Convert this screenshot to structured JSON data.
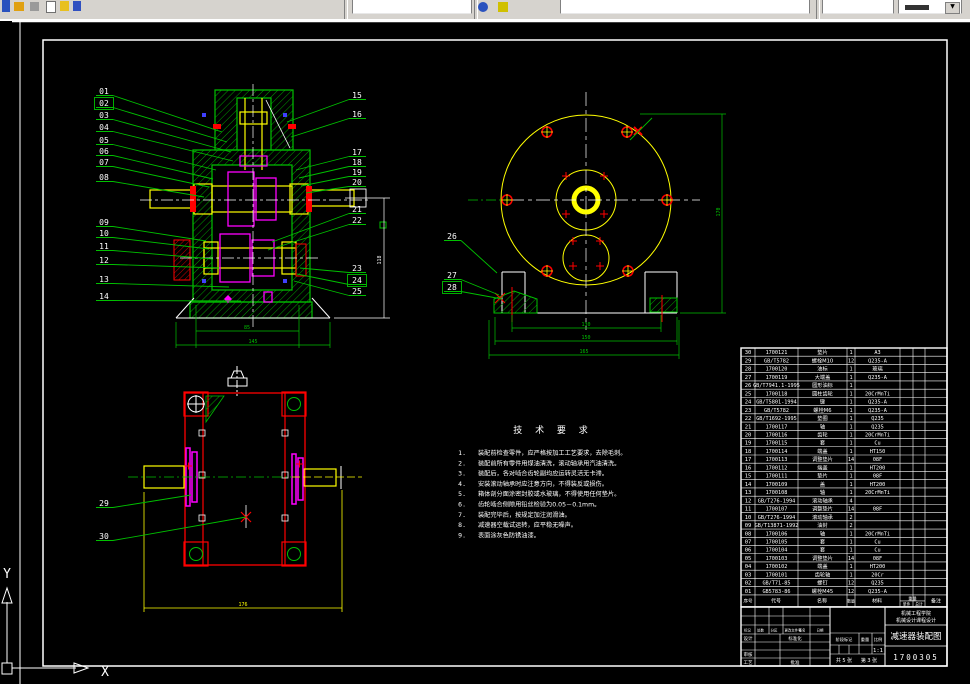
{
  "toolbar": {
    "layer_combo_value": "ByLayer"
  },
  "frame": {
    "ucs_x_label": "X",
    "ucs_y_label": "Y"
  },
  "tech": {
    "title": "技 术 要 求",
    "items": [
      "装配前检查零件，应严格按加工工艺要求，去除毛刺。",
      "装配前所有零件用煤油清洗，滚动轴承用汽油清洗。",
      "装配后，各对啮合齿轮副均应运转灵活无卡滞。",
      "安装滚动轴承时应注意方向，不得装反或损伤。",
      "箱体剖分面涂密封胶或水玻璃，不得使用任何垫片。",
      "齿轮啮合侧隙用铅丝检验为0.05－0.1mm。",
      "装配完毕后，按规定加注润滑油。",
      "减速器空载试运转，应平稳无噪声。",
      "表面涂灰色防锈油漆。"
    ]
  },
  "dims": {
    "view1_bottom": [
      "85",
      "145"
    ],
    "view1_side": "118",
    "view2_bottom": [
      "130",
      "150",
      "165"
    ],
    "view2_side": "170",
    "view3_width": "176"
  },
  "callouts": [
    {
      "n": "01",
      "x": 104,
      "y": 91,
      "tx": 222,
      "ty": 132,
      "s": "L",
      "b": false
    },
    {
      "n": "02",
      "x": 104,
      "y": 103,
      "tx": 227,
      "ty": 142,
      "s": "L",
      "b": true
    },
    {
      "n": "03",
      "x": 104,
      "y": 115,
      "tx": 231,
      "ty": 152,
      "s": "L",
      "b": false
    },
    {
      "n": "04",
      "x": 104,
      "y": 127,
      "tx": 233,
      "ty": 161,
      "s": "L",
      "b": false
    },
    {
      "n": "05",
      "x": 104,
      "y": 140,
      "tx": 216,
      "ty": 170,
      "s": "L",
      "b": false
    },
    {
      "n": "06",
      "x": 104,
      "y": 151,
      "tx": 213,
      "ty": 179,
      "s": "L",
      "b": false
    },
    {
      "n": "07",
      "x": 104,
      "y": 162,
      "tx": 209,
      "ty": 187,
      "s": "L",
      "b": false
    },
    {
      "n": "08",
      "x": 104,
      "y": 177,
      "tx": 204,
      "ty": 197,
      "s": "L",
      "b": false
    },
    {
      "n": "09",
      "x": 104,
      "y": 222,
      "tx": 206,
      "ty": 241,
      "s": "L",
      "b": false
    },
    {
      "n": "10",
      "x": 104,
      "y": 233,
      "tx": 209,
      "ty": 249,
      "s": "L",
      "b": false
    },
    {
      "n": "11",
      "x": 104,
      "y": 246,
      "tx": 213,
      "ty": 259,
      "s": "L",
      "b": false
    },
    {
      "n": "12",
      "x": 104,
      "y": 260,
      "tx": 219,
      "ty": 268,
      "s": "L",
      "b": false
    },
    {
      "n": "13",
      "x": 104,
      "y": 279,
      "tx": 229,
      "ty": 287,
      "s": "L",
      "b": false
    },
    {
      "n": "14",
      "x": 104,
      "y": 296,
      "tx": 241,
      "ty": 301,
      "s": "L",
      "b": false
    },
    {
      "n": "15",
      "x": 357,
      "y": 95,
      "tx": 287,
      "ty": 122,
      "s": "R",
      "b": false
    },
    {
      "n": "16",
      "x": 357,
      "y": 114,
      "tx": 291,
      "ty": 137,
      "s": "R",
      "b": false
    },
    {
      "n": "17",
      "x": 357,
      "y": 152,
      "tx": 296,
      "ty": 170,
      "s": "R",
      "b": false
    },
    {
      "n": "18",
      "x": 357,
      "y": 162,
      "tx": 299,
      "ty": 178,
      "s": "R",
      "b": false
    },
    {
      "n": "19",
      "x": 357,
      "y": 172,
      "tx": 301,
      "ty": 186,
      "s": "R",
      "b": false
    },
    {
      "n": "20",
      "x": 357,
      "y": 182,
      "tx": 306,
      "ty": 193,
      "s": "R",
      "b": false
    },
    {
      "n": "21",
      "x": 357,
      "y": 209,
      "tx": 272,
      "ty": 242,
      "s": "R",
      "b": false
    },
    {
      "n": "22",
      "x": 357,
      "y": 220,
      "tx": 268,
      "ty": 250,
      "s": "R",
      "b": false
    },
    {
      "n": "23",
      "x": 357,
      "y": 268,
      "tx": 300,
      "ty": 268,
      "s": "R",
      "b": false
    },
    {
      "n": "24",
      "x": 357,
      "y": 280,
      "tx": 297,
      "ty": 274,
      "s": "R",
      "b": true
    },
    {
      "n": "25",
      "x": 357,
      "y": 291,
      "tx": 294,
      "ty": 281,
      "s": "R",
      "b": false
    },
    {
      "n": "26",
      "x": 452,
      "y": 236,
      "tx": 497,
      "ty": 273,
      "s": "L",
      "b": false
    },
    {
      "n": "27",
      "x": 452,
      "y": 275,
      "tx": 499,
      "ty": 295,
      "s": "L",
      "b": false
    },
    {
      "n": "28",
      "x": 452,
      "y": 287,
      "tx": 502,
      "ty": 299,
      "s": "L",
      "b": true
    },
    {
      "n": "29",
      "x": 104,
      "y": 503,
      "tx": 191,
      "ty": 495,
      "s": "L",
      "b": false
    },
    {
      "n": "30",
      "x": 104,
      "y": 536,
      "tx": 246,
      "ty": 517,
      "s": "L",
      "b": false
    }
  ],
  "bom": {
    "headers": {
      "no": "序号",
      "code": "代号",
      "name": "名称",
      "qty": "数量",
      "material": "材料",
      "weight": "重量",
      "single": "单件",
      "total": "总计",
      "remark": "备注"
    },
    "rows": [
      [
        "30",
        "1700121",
        "垫片",
        "1",
        "A3"
      ],
      [
        "29",
        "GB/T5782",
        "螺栓M10",
        "12",
        "Q235-A"
      ],
      [
        "28",
        "1700120",
        "油标",
        "1",
        "玻璃"
      ],
      [
        "27",
        "1700119",
        "大端盖",
        "1",
        "Q235-A"
      ],
      [
        "26",
        "GB/T7941.1-1995",
        "圆形油标",
        "1",
        ""
      ],
      [
        "25",
        "1700118",
        "圆柱齿轮",
        "1",
        "20CrMnTi"
      ],
      [
        "24",
        "GB/T5801-1994",
        "键",
        "1",
        "Q235-A"
      ],
      [
        "23",
        "GB/T5782",
        "螺栓M6",
        "1",
        "Q235-A"
      ],
      [
        "22",
        "GB/T1692-1995",
        "垫圈",
        "1",
        "Q235"
      ],
      [
        "21",
        "1700117",
        "轴",
        "1",
        "Q235"
      ],
      [
        "20",
        "1700116",
        "齿轮",
        "1",
        "20CrMnTi"
      ],
      [
        "19",
        "1700115",
        "套",
        "1",
        "Cu"
      ],
      [
        "18",
        "1700114",
        "端盖",
        "1",
        "HT150"
      ],
      [
        "17",
        "1700113",
        "调整垫片",
        "14",
        "08F"
      ],
      [
        "16",
        "1700112",
        "端盖",
        "1",
        "HT200"
      ],
      [
        "15",
        "1700111",
        "垫片",
        "1",
        "08F"
      ],
      [
        "14",
        "1700109",
        "盖",
        "1",
        "HT200"
      ],
      [
        "13",
        "1700108",
        "轴",
        "1",
        "20CrMnTi"
      ],
      [
        "12",
        "GB/T276-1994",
        "滚动轴承",
        "4",
        ""
      ],
      [
        "11",
        "1700107",
        "调整垫片",
        "14",
        "08F"
      ],
      [
        "10",
        "GB/T276-1994",
        "滚动轴承",
        "2",
        ""
      ],
      [
        "09",
        "GB/T13871-1992",
        "油封",
        "2",
        ""
      ],
      [
        "08",
        "1700106",
        "轴",
        "1",
        "20CrMnTi"
      ],
      [
        "07",
        "1700105",
        "套",
        "1",
        "Cu"
      ],
      [
        "06",
        "1700104",
        "套",
        "1",
        "Cu"
      ],
      [
        "05",
        "1700103",
        "调整垫片",
        "14",
        "08F"
      ],
      [
        "04",
        "1700102",
        "端盖",
        "1",
        "HT200"
      ],
      [
        "03",
        "1700101",
        "齿轮轴",
        "1",
        "20Cr"
      ],
      [
        "02",
        "GB/T71-85",
        "螺钉",
        "12",
        "Q235"
      ],
      [
        "01",
        "GB5783-86",
        "螺栓M45",
        "12",
        "Q235-A"
      ]
    ]
  },
  "title_block": {
    "org_line1": "机械工程学院",
    "org_line2": "机械设计课程设计",
    "title": "减速器装配图",
    "drawing_no": "1700305",
    "scale_value": "1:1",
    "stage_label": "阶段标记",
    "weight_label": "重量",
    "scale_label": "比例",
    "sheets_total": "共 5 张",
    "sheet_no": "第 3 张",
    "left_header": [
      "标记",
      "处数",
      "分区",
      "更改文件号",
      "签名",
      "日期"
    ],
    "row_design": "设计",
    "row_check": "审核",
    "row_process": "工艺",
    "std_label": "标准化",
    "approve_label": "批准"
  }
}
